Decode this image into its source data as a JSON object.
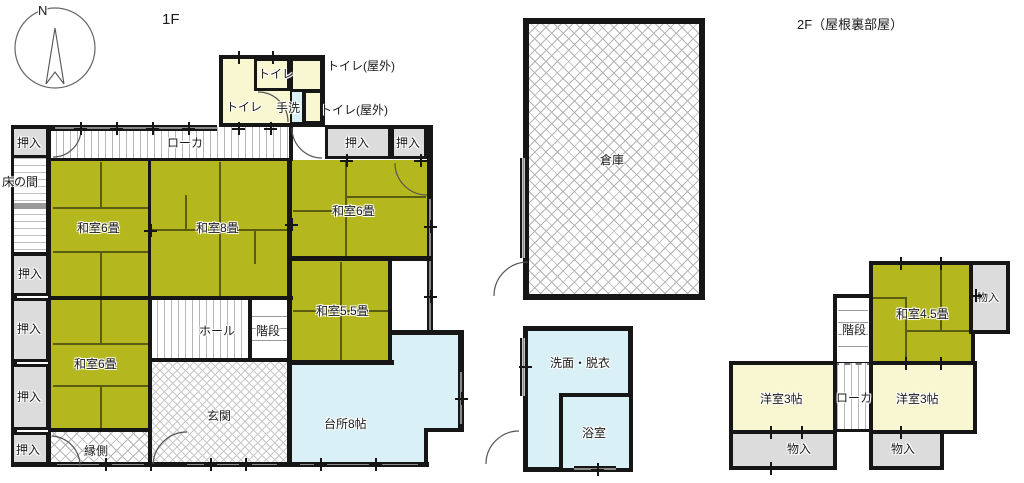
{
  "titles": {
    "floor1": "1F",
    "floor2": "2F（屋根裏部屋）"
  },
  "compass": {
    "letter": "N"
  },
  "f1": {
    "oshiire": "押入",
    "rouka": "ローカ",
    "tokonoma": "床の間",
    "washitsu6": "和室6畳",
    "washitsu8": "和室8畳",
    "washitsu55": "和室5.5畳",
    "hall": "ホール",
    "kaidan": "階段",
    "genkan": "玄関",
    "daidokoro": "台所8帖",
    "engawa": "縁側",
    "toire": "トイレ",
    "tearai": "手洗",
    "toire_okugai": "トイレ(屋外)",
    "souko": "倉庫",
    "senmen_datsui": "洗面・脱衣",
    "yokushitsu": "浴室"
  },
  "f2": {
    "washitsu45": "和室4.5畳",
    "monoiri": "物入",
    "kaidan": "階段",
    "yoshitsu3": "洋室3帖",
    "rouka": "ローカ"
  },
  "colors": {
    "tatami": "#b5b71e",
    "cream": "#f9f6d2",
    "cyan": "#d8f0f6",
    "gray": "#dcdcdc",
    "wall": "#161616"
  }
}
